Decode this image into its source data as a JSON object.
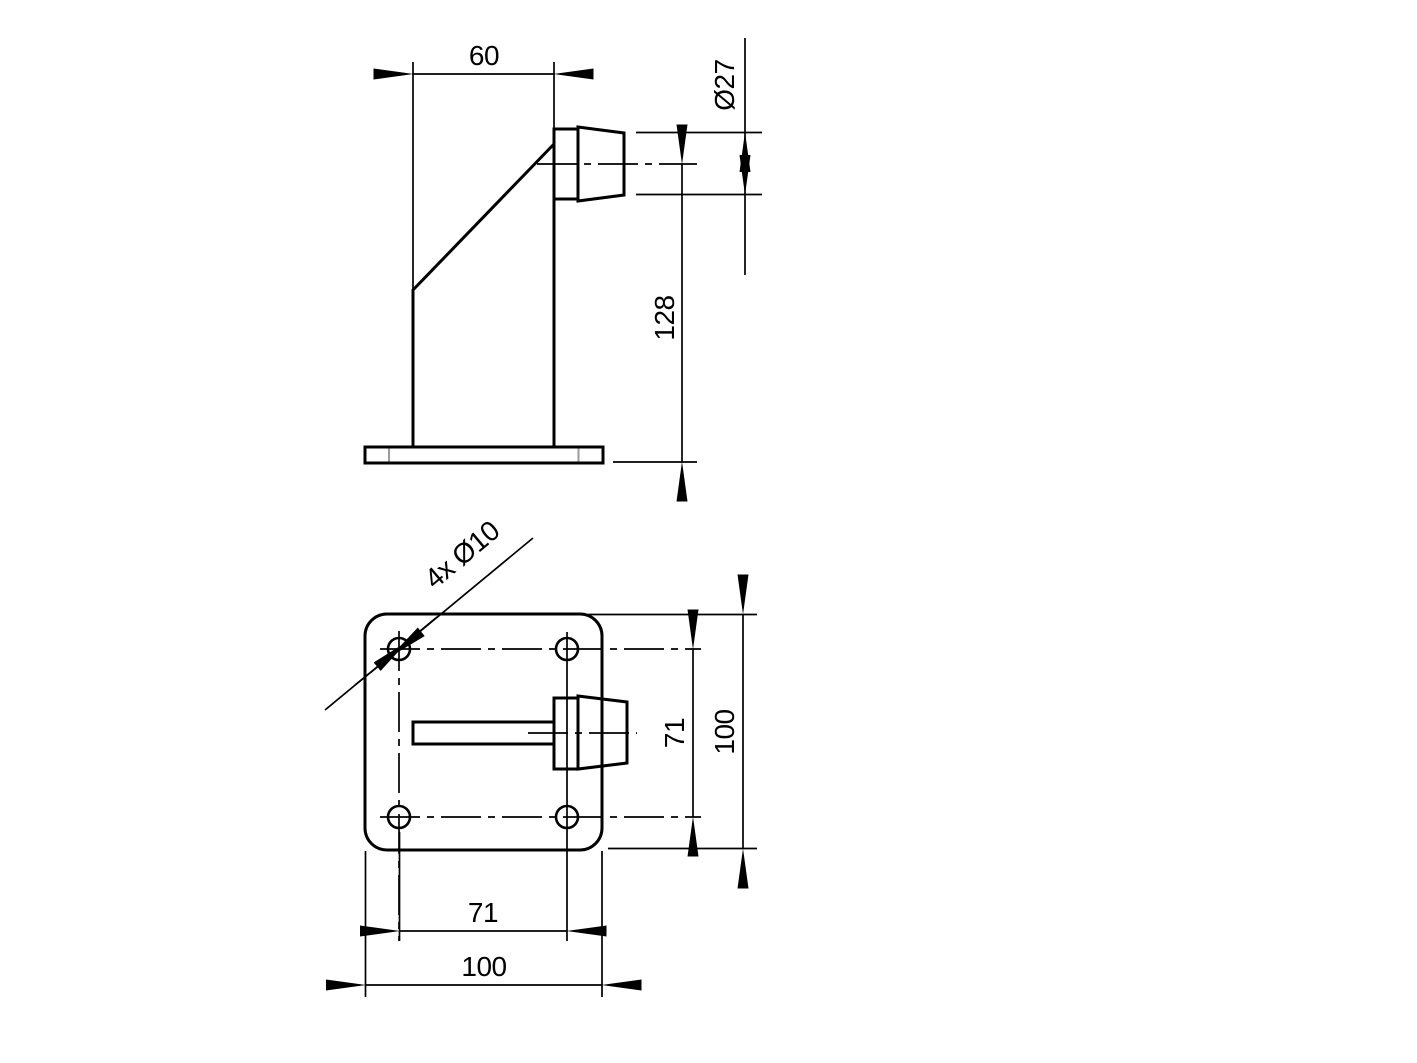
{
  "drawing": {
    "colors": {
      "background": "#ffffff",
      "line": "#000000",
      "tangent_edge": "#9b9b9b"
    },
    "side_view": {
      "dim_depth": "60",
      "dim_buffer_diameter": "Ø27",
      "dim_height": "128"
    },
    "plan_view": {
      "leader_holes": "4x Ø10",
      "dim_hole_spacing_vertical": "71",
      "dim_plate_vertical": "100",
      "dim_hole_spacing_horizontal": "71",
      "dim_plate_horizontal": "100"
    }
  }
}
